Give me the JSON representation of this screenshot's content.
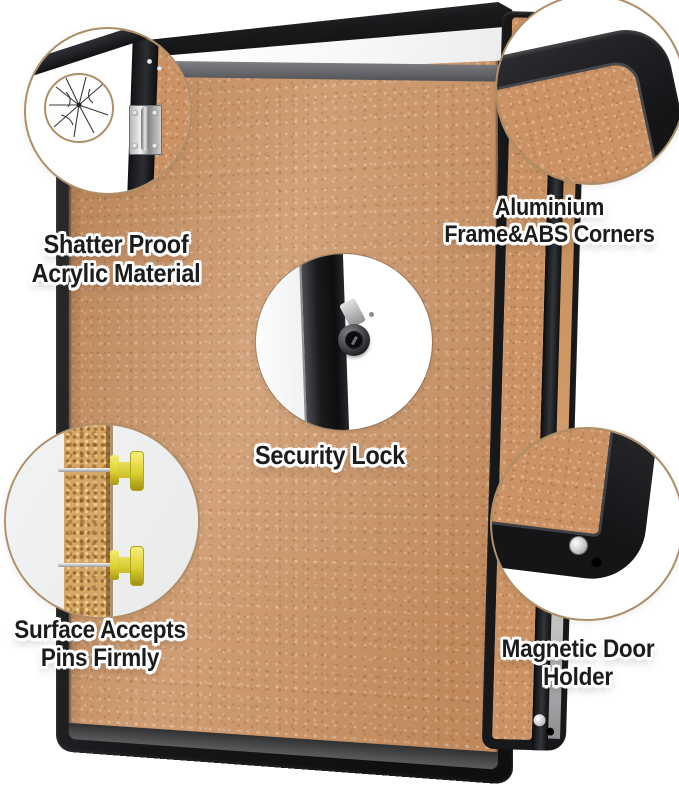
{
  "callouts": {
    "shatter_proof": {
      "label": "Shatter Proof\nAcrylic Material"
    },
    "aluminium_frame": {
      "label": "Aluminium\nFrame&ABS Corners"
    },
    "security_lock": {
      "label": "Security Lock"
    },
    "surface_pins": {
      "label": "Surface Accepts\nPins Firmly"
    },
    "magnetic_holder": {
      "label": "Magnetic Door\nHolder"
    }
  },
  "colors": {
    "cork": "#cb9365",
    "cork_closeup": "#bc7e50",
    "frame_black": "#17181a",
    "bezel_gray": "#5a5b5d",
    "circle_border": "#b08e66",
    "pin_yellow": "#ddd12f",
    "label_text": "#1c1c1c",
    "label_outline": "#ffffff"
  }
}
